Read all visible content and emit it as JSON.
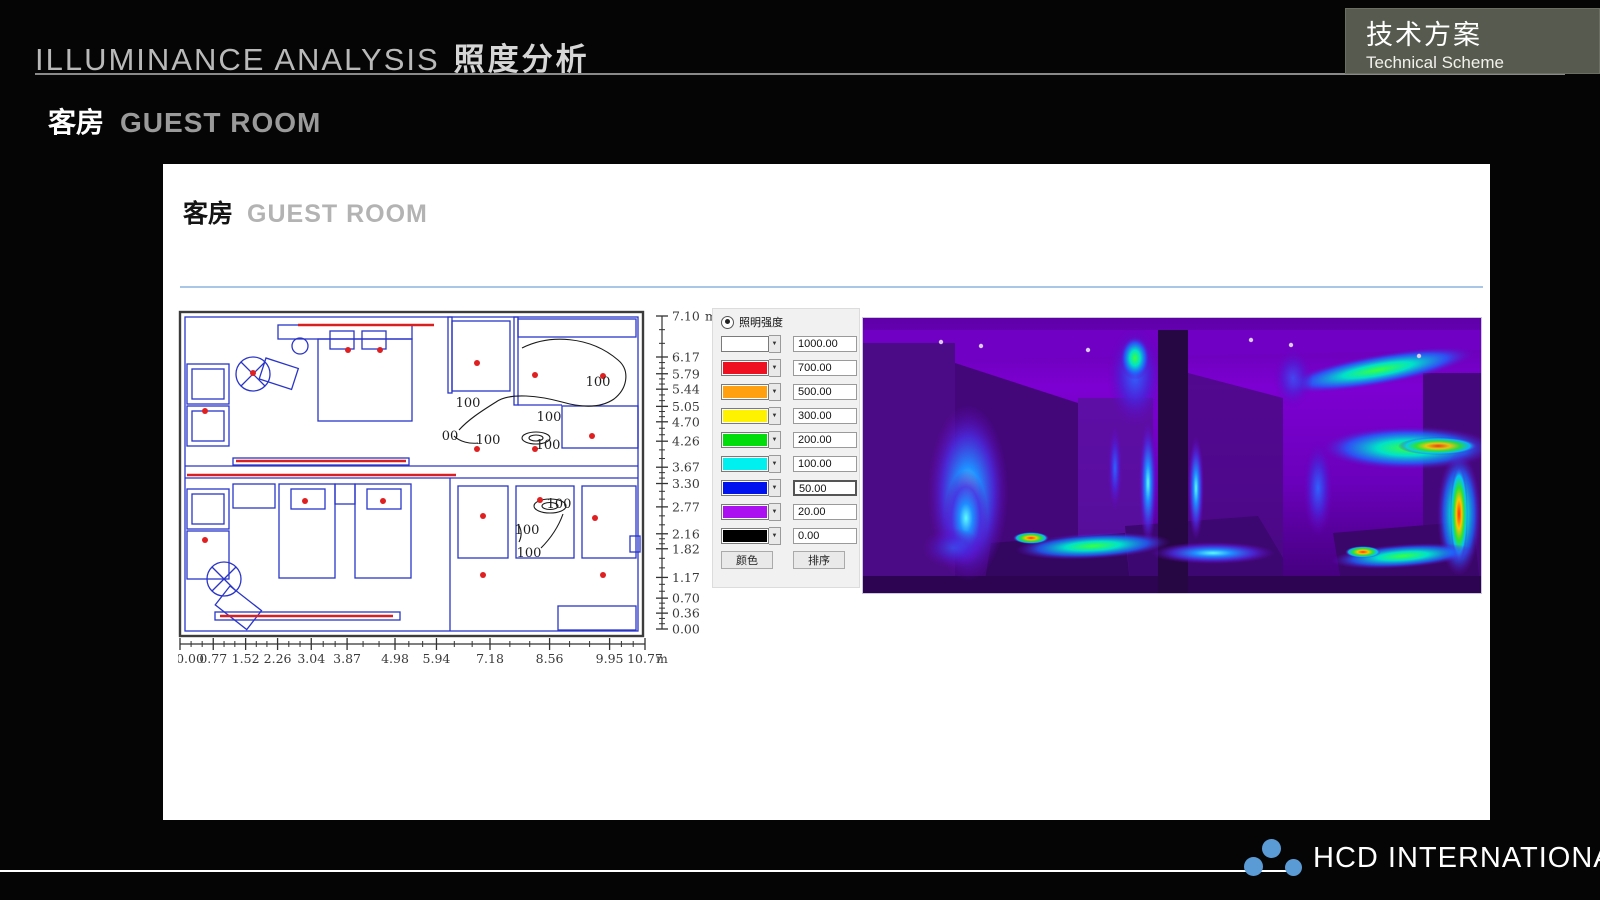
{
  "header": {
    "title_en": "ILLUMINANCE  ANALYSIS",
    "title_zh": "照度分析",
    "scheme_zh": "技术方案",
    "scheme_en": "Technical Scheme"
  },
  "subtitle": {
    "zh": "客房",
    "en": "GUEST ROOM"
  },
  "panel": {
    "title_zh": "客房",
    "title_en": "GUEST ROOM"
  },
  "footer": {
    "brand": "HCD INTERNATIONAL"
  },
  "colors": {
    "accent_line": "#a9c6e6",
    "logo_dot": "#5b9bd5",
    "plan_line": "#2a35c8",
    "lamp_dot": "#e02020",
    "scheme_box_bg": "#575b4f"
  },
  "chart_data": {
    "type": "heatmap",
    "title": "客房 GUEST ROOM 照度分析 — illuminance plan with false-color rendering",
    "x_axis": {
      "unit": "m",
      "range": [
        0,
        10.77
      ],
      "ticks": [
        "0.00",
        "0.77",
        "1.52",
        "2.26",
        "3.04",
        "3.87",
        "4.98",
        "5.94",
        "7.18",
        "8.56",
        "9.95",
        "10.77"
      ]
    },
    "y_axis": {
      "unit": "m",
      "range": [
        0,
        7.1
      ],
      "ticks": [
        "7.10",
        "6.17",
        "5.79",
        "5.44",
        "5.05",
        "4.70",
        "4.26",
        "3.67",
        "3.30",
        "2.77",
        "2.16",
        "1.82",
        "1.17",
        "0.70",
        "0.36",
        "0.00"
      ]
    },
    "legend": {
      "label": "照明强度",
      "entries": [
        {
          "color": "#ffffff",
          "value": "1000.00"
        },
        {
          "color": "#ee1020",
          "value": "700.00"
        },
        {
          "color": "#ffa010",
          "value": "500.00"
        },
        {
          "color": "#fff200",
          "value": "300.00"
        },
        {
          "color": "#00dd0a",
          "value": "200.00"
        },
        {
          "color": "#00f0f0",
          "value": "100.00"
        },
        {
          "color": "#0012ee",
          "value": "50.00",
          "focused": true
        },
        {
          "color": "#aa10f0",
          "value": "20.00"
        },
        {
          "color": "#000000",
          "value": "0.00"
        }
      ],
      "buttons": [
        "颜色",
        "排序"
      ]
    },
    "contour_labels": [
      {
        "text": "100",
        "x": 290,
        "y": 101
      },
      {
        "text": "100",
        "x": 420,
        "y": 80
      },
      {
        "text": "100",
        "x": 371,
        "y": 115
      },
      {
        "text": "00",
        "x": 272,
        "y": 134
      },
      {
        "text": "100",
        "x": 310,
        "y": 138
      },
      {
        "text": "100",
        "x": 370,
        "y": 143
      },
      {
        "text": "100",
        "x": 381,
        "y": 202
      },
      {
        "text": "100",
        "x": 349,
        "y": 228
      },
      {
        "text": "100",
        "x": 351,
        "y": 251
      }
    ],
    "lamp_points": [
      {
        "x": 170,
        "y": 44
      },
      {
        "x": 202,
        "y": 44
      },
      {
        "x": 27,
        "y": 105
      },
      {
        "x": 75,
        "y": 67
      },
      {
        "x": 299,
        "y": 57
      },
      {
        "x": 357,
        "y": 69
      },
      {
        "x": 425,
        "y": 70
      },
      {
        "x": 299,
        "y": 143
      },
      {
        "x": 357,
        "y": 143
      },
      {
        "x": 414,
        "y": 130
      },
      {
        "x": 127,
        "y": 195
      },
      {
        "x": 205,
        "y": 195
      },
      {
        "x": 27,
        "y": 234
      },
      {
        "x": 305,
        "y": 210
      },
      {
        "x": 362,
        "y": 194
      },
      {
        "x": 417,
        "y": 212
      },
      {
        "x": 305,
        "y": 269
      },
      {
        "x": 425,
        "y": 269
      }
    ]
  }
}
